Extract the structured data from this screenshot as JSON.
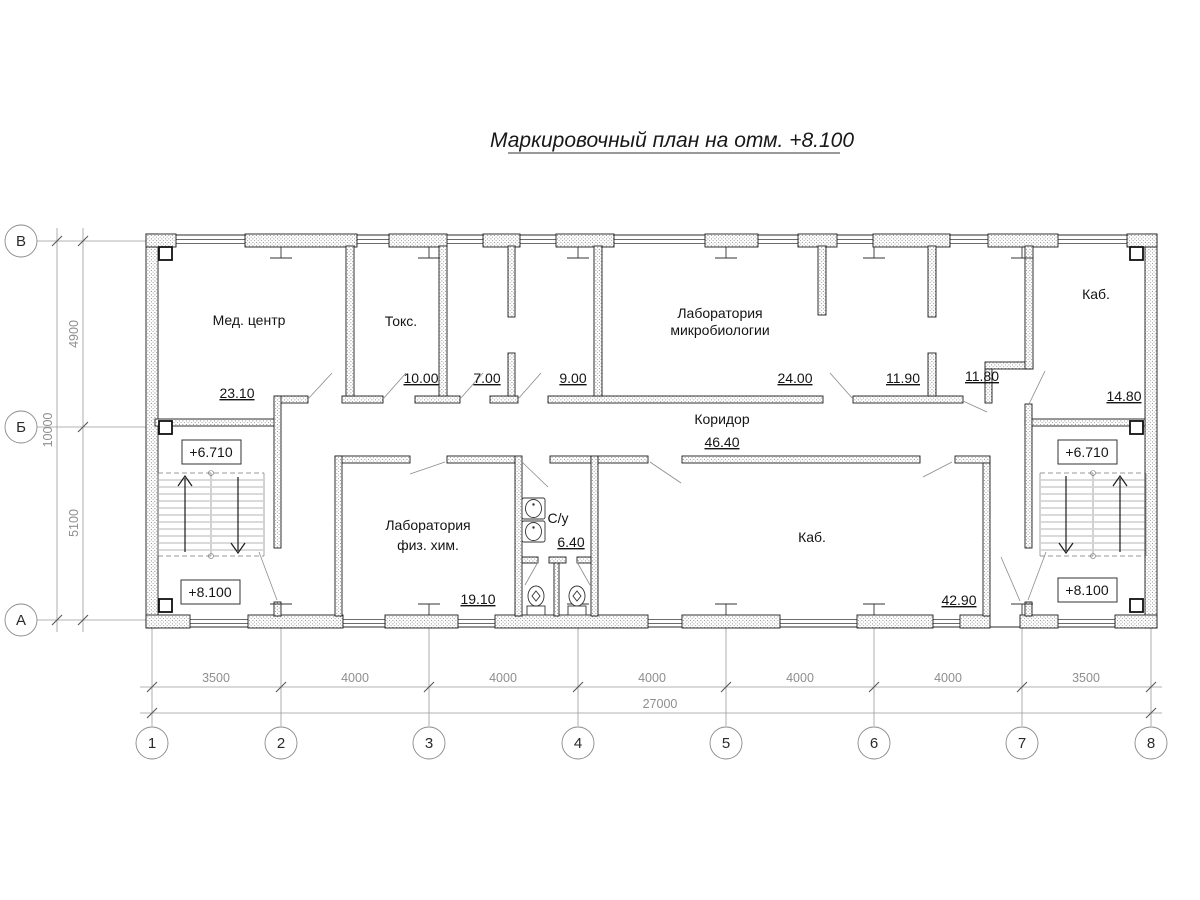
{
  "title": "Маркировочный план на отм. +8.100",
  "axes": {
    "rows": [
      "В",
      "Б",
      "А"
    ],
    "cols": [
      "1",
      "2",
      "3",
      "4",
      "5",
      "6",
      "7",
      "8"
    ]
  },
  "dims": {
    "left_total": "10000",
    "left_segs": [
      "4900",
      "5100"
    ],
    "bottom_total": "27000",
    "bottom_segs": [
      "3500",
      "4000",
      "4000",
      "4000",
      "4000",
      "4000",
      "3500"
    ]
  },
  "levels": {
    "upper": "+6.710",
    "current": "+8.100"
  },
  "rooms": {
    "med": {
      "name": "Мед. центр",
      "area": "23.10"
    },
    "toks": {
      "name": "Токс.",
      "area": "10.00"
    },
    "r700": {
      "area": "7.00"
    },
    "r900": {
      "area": "9.00"
    },
    "micro": {
      "line1": "Лаборатория",
      "line2": "микробиологии",
      "area": "24.00"
    },
    "r1190": {
      "area": "11.90"
    },
    "r1180": {
      "area": "11.80"
    },
    "kab_top": {
      "name": "Каб.",
      "area": "14.80"
    },
    "corridor": {
      "name": "Коридор",
      "area": "46.40"
    },
    "fizhim": {
      "line1": "Лаборатория",
      "line2": "физ. хим.",
      "area": "19.10"
    },
    "su": {
      "name": "С/у",
      "area": "6.40"
    },
    "kab_bot": {
      "name": "Каб.",
      "area": "42.90"
    }
  }
}
